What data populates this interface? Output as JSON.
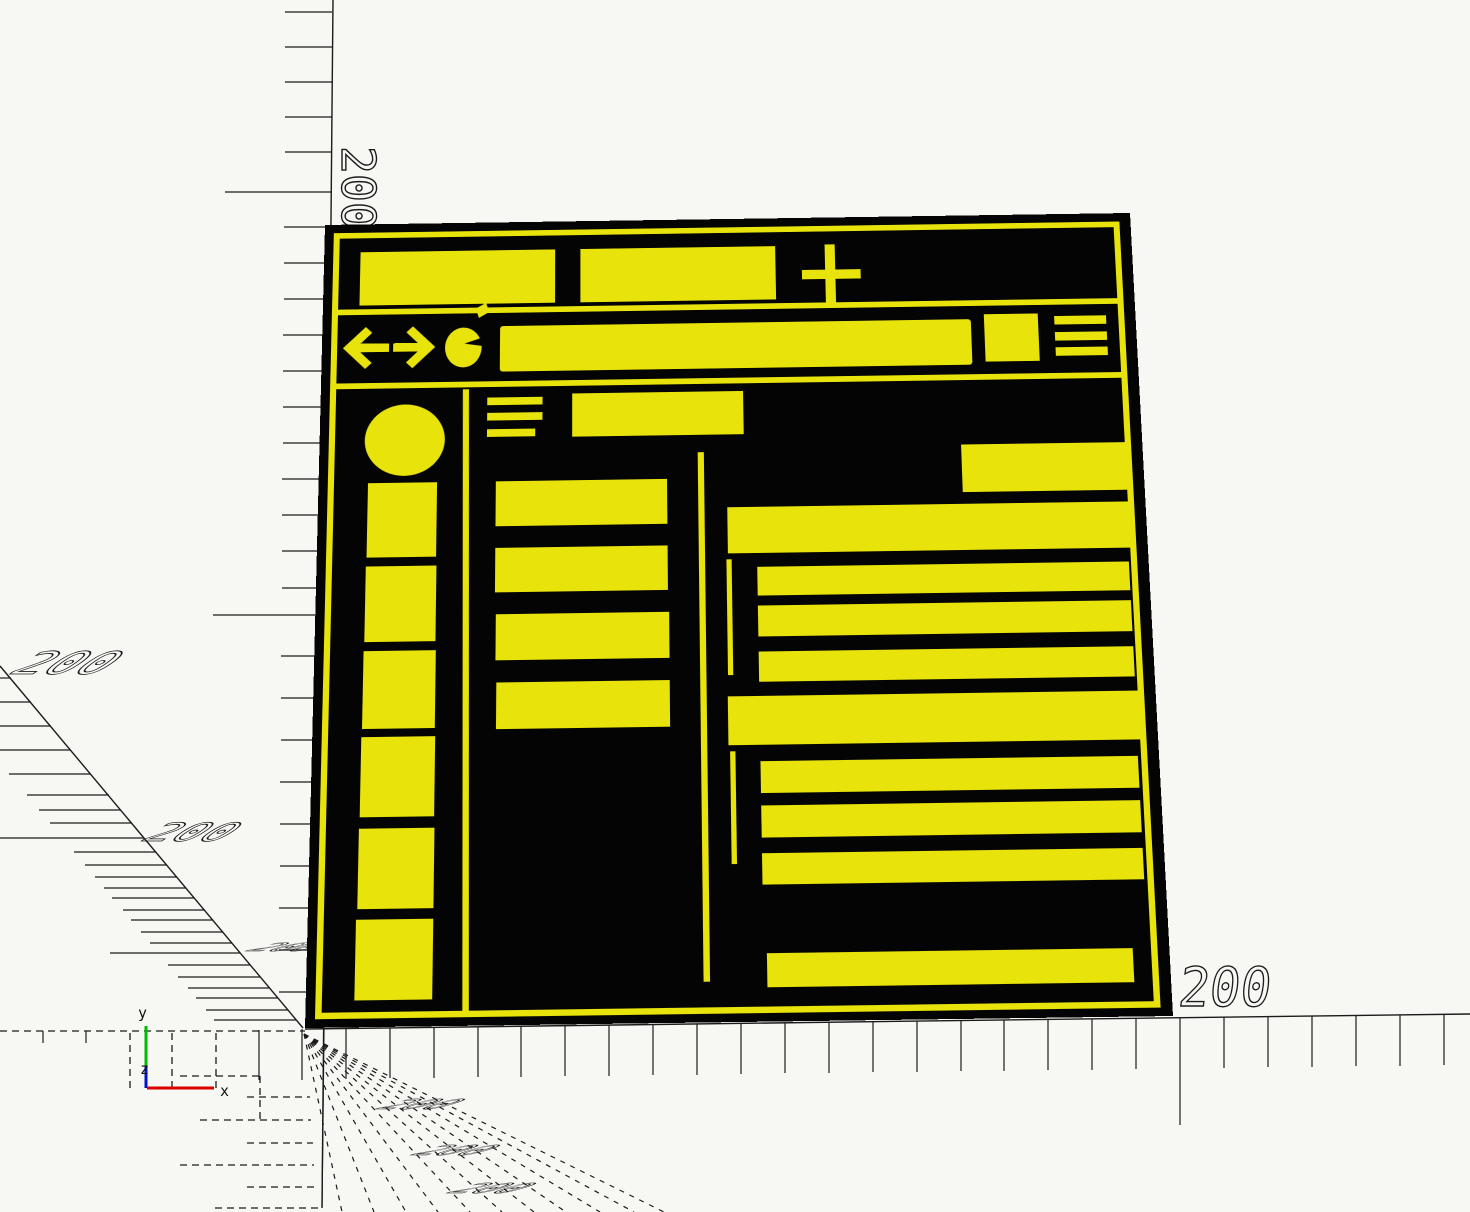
{
  "scene": {
    "kind": "cad-viewport-wireframe",
    "background_color": "#f7f7f4",
    "line_color": "#1b1b1b",
    "drawing_accent_color": "#e8e30b",
    "drawing_frame_color": "#040404"
  },
  "axis_gizmo": {
    "x_label": "x",
    "y_label": "y",
    "z_label": "z",
    "x_color": "#dd0000",
    "y_color": "#00bb00",
    "z_color": "#0013cc"
  },
  "dimension_labels": {
    "ruler_left_rotated": "200",
    "diagonal_upper": "200",
    "diagonal_lower": "200",
    "diagonal_flat_0": "200",
    "diagonal_flat_1": "200",
    "diagonal_flat_2": "200",
    "diagonal_flat_3": "200",
    "bottom_right": "200"
  }
}
